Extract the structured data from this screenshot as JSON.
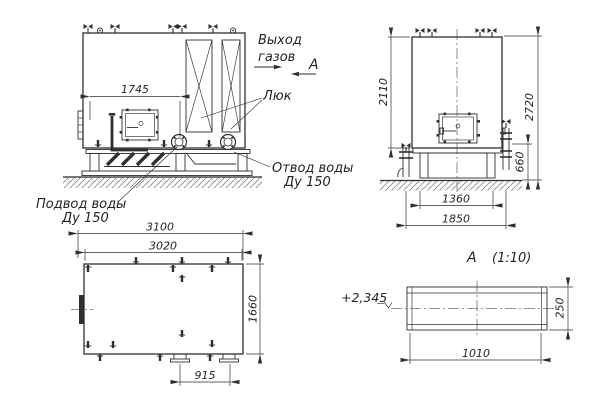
{
  "meta": {
    "type": "technical-drawing",
    "subject": "boiler unit general views",
    "background_color": "#ffffff",
    "line_color": "#2f2f2f"
  },
  "labels": {
    "gas_out_1": "Выход",
    "gas_out_2": "газов",
    "section_mark": "А",
    "hatch_label": "Люк",
    "outlet_1": "Отвод воды",
    "outlet_2": "Ду 150",
    "inlet_1": "Подвод воды",
    "inlet_2": "Ду 150",
    "section_title_letter": "А",
    "section_title_scale": "(1:10)",
    "elevation_mark": "+2,345"
  },
  "dims": {
    "front_hatch_span": "1745",
    "side_body_height": "2110",
    "side_total_height": "2720",
    "side_base_height": "660",
    "side_frame_width": "1360",
    "side_overall_width": "1850",
    "plan_overall_length": "3100",
    "plan_body_length": "3020",
    "plan_width": "1660",
    "plan_nozzle_spacing": "915",
    "section_duct_width": "1010",
    "section_duct_height": "250"
  }
}
